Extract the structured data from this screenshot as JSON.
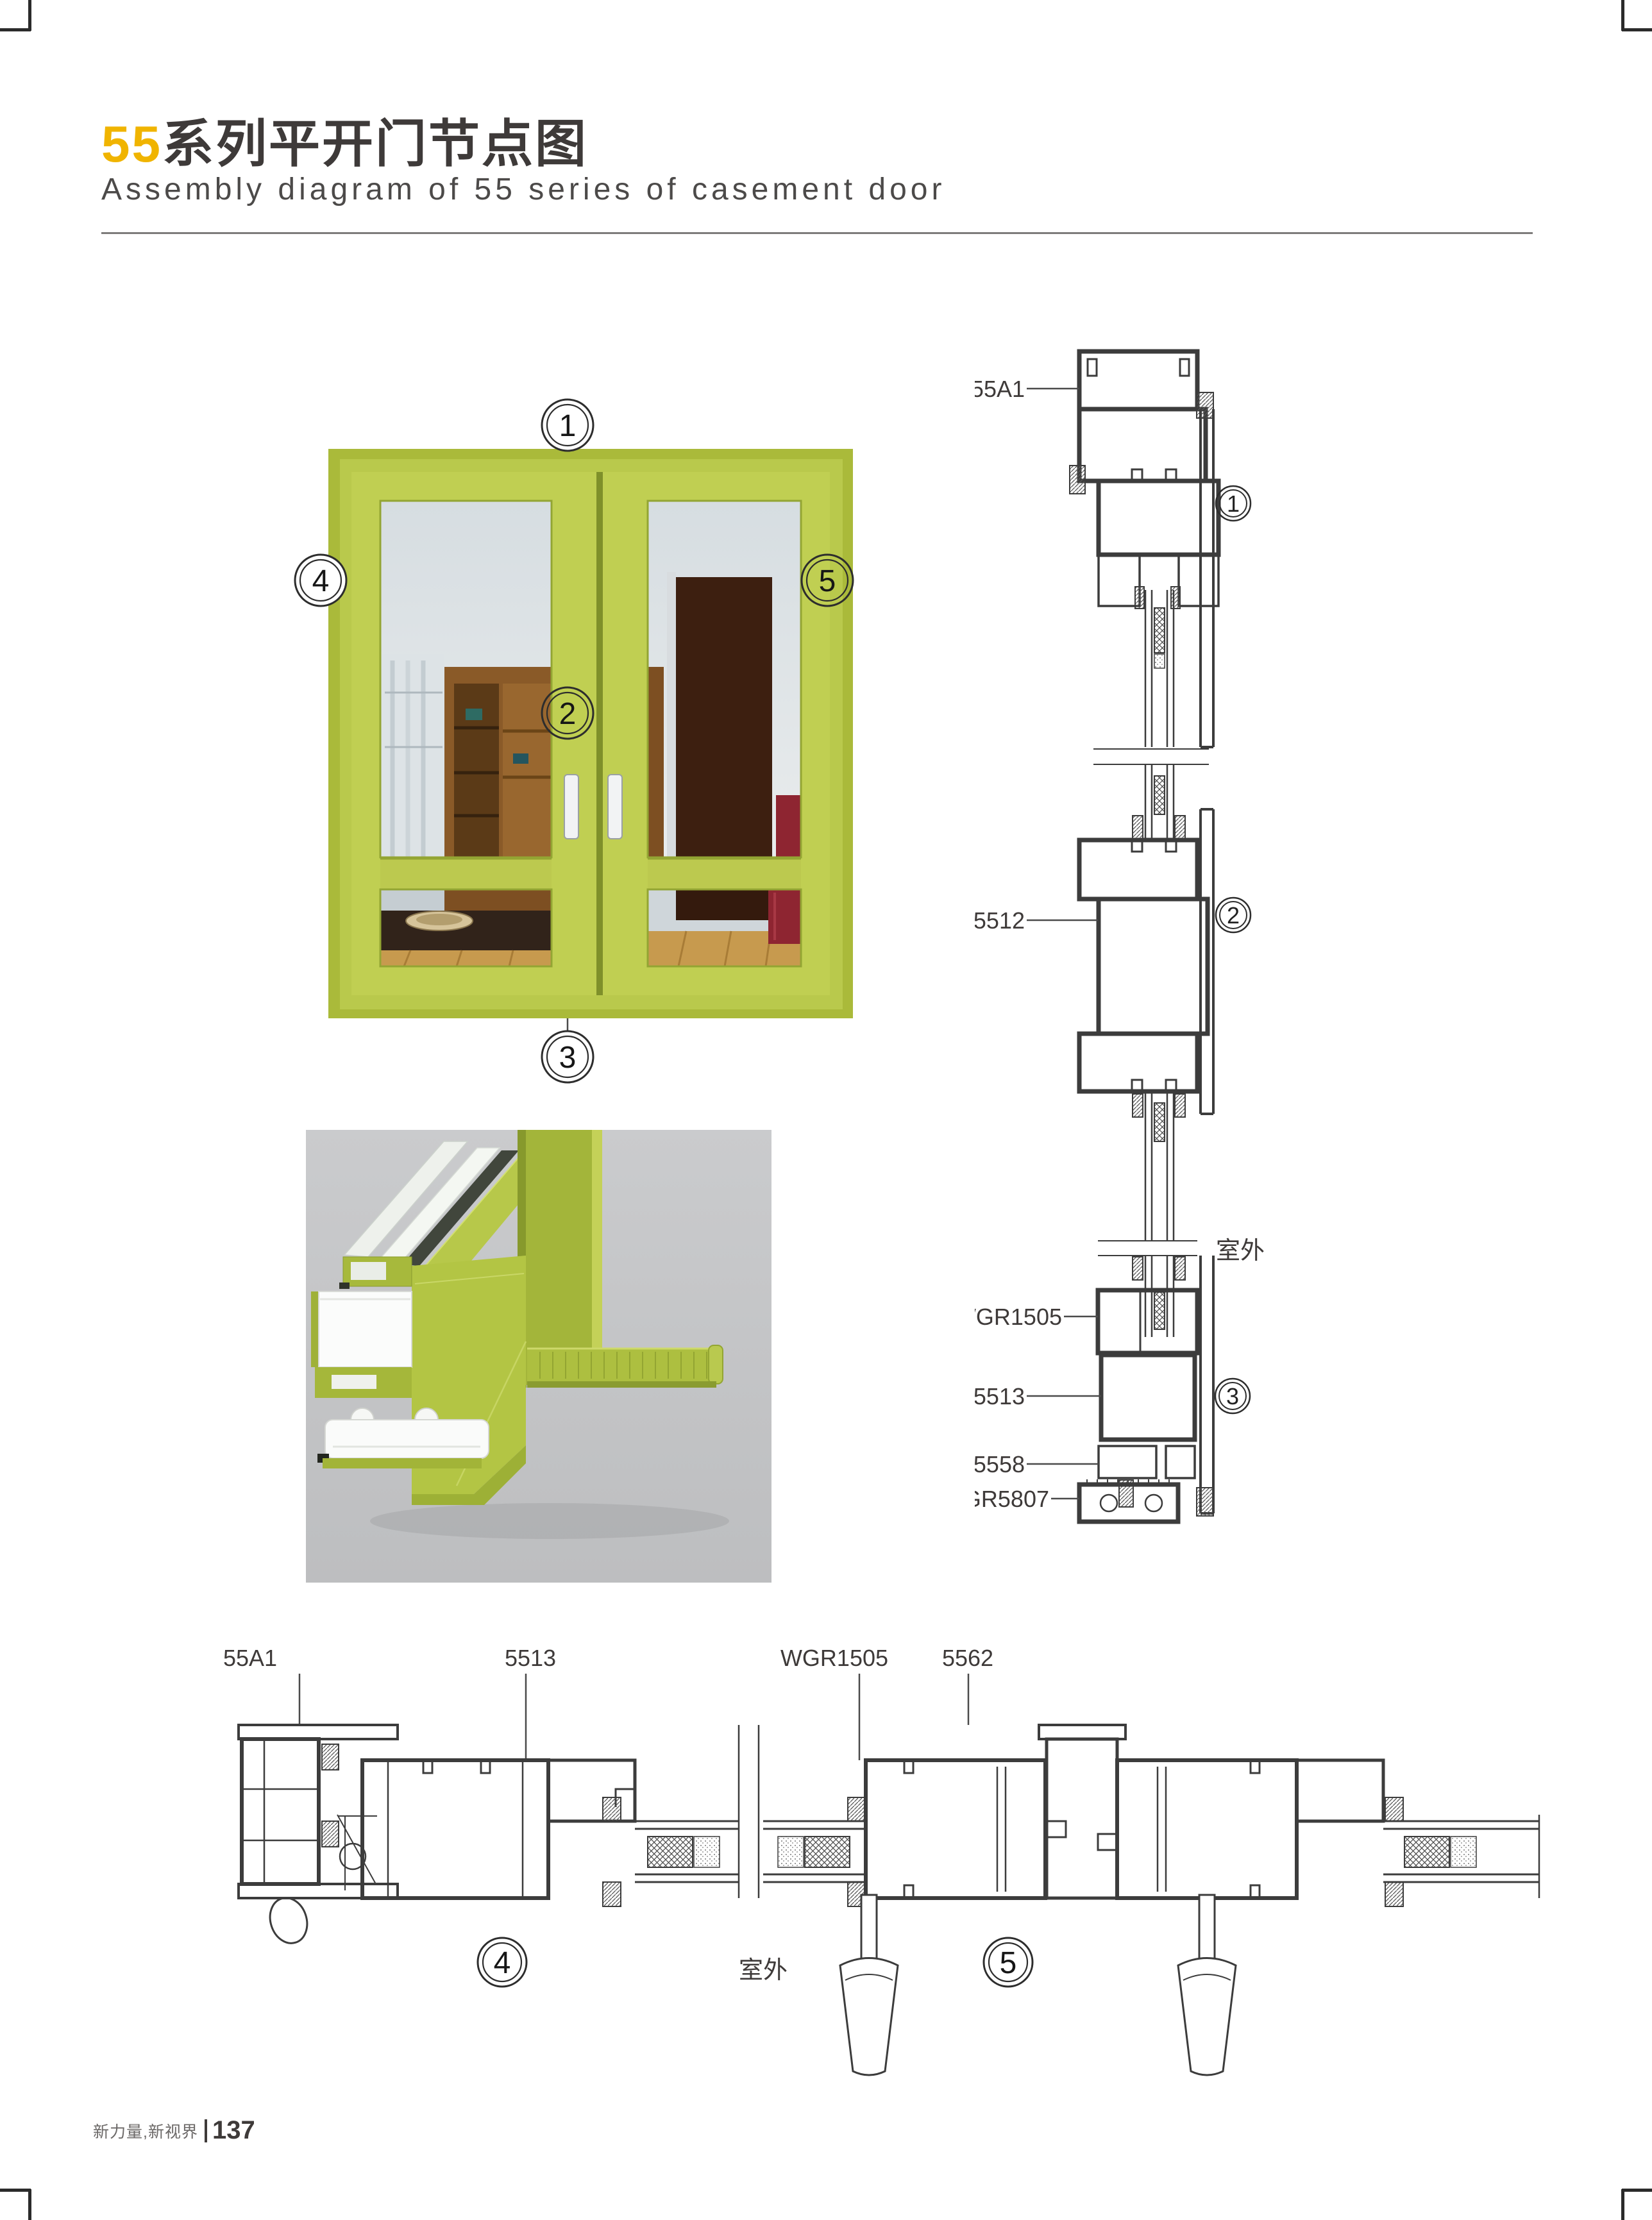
{
  "header": {
    "title_accent": "55",
    "title_text": "系列平开门节点图",
    "subtitle": "Assembly diagram of 55 series of casement door"
  },
  "photo": {
    "callout_1": "1",
    "callout_2": "2",
    "callout_3": "3",
    "callout_4": "4",
    "callout_5": "5"
  },
  "vertical_section": {
    "label_frame": "55A1",
    "label_mullion": "5512",
    "label_glazing_bead": "WGR1505",
    "label_sash": "5513",
    "label_bead": "5558",
    "label_threshold": "GR5807",
    "outdoor": "室外",
    "detail_1": "1",
    "detail_2": "2",
    "detail_3": "3"
  },
  "horizontal_section": {
    "label_frame": "55A1",
    "label_sash": "5513",
    "label_glazing_bead": "WGR1505",
    "label_astragal": "5562",
    "outdoor": "室外",
    "detail_4": "4",
    "detail_5": "5"
  },
  "footer": {
    "brand": "新力量,新视界",
    "page": "137"
  },
  "colors": {
    "accent_yellow": "#F0B400",
    "ink": "#3E3A39",
    "drawing_line": "#3C3C3C",
    "door_green": "#B5C646",
    "door_green_light": "#C6D45C",
    "render_background": "#C7C8CA",
    "sofa_red": "#8E2531",
    "wood_brown": "#8A5A28"
  }
}
